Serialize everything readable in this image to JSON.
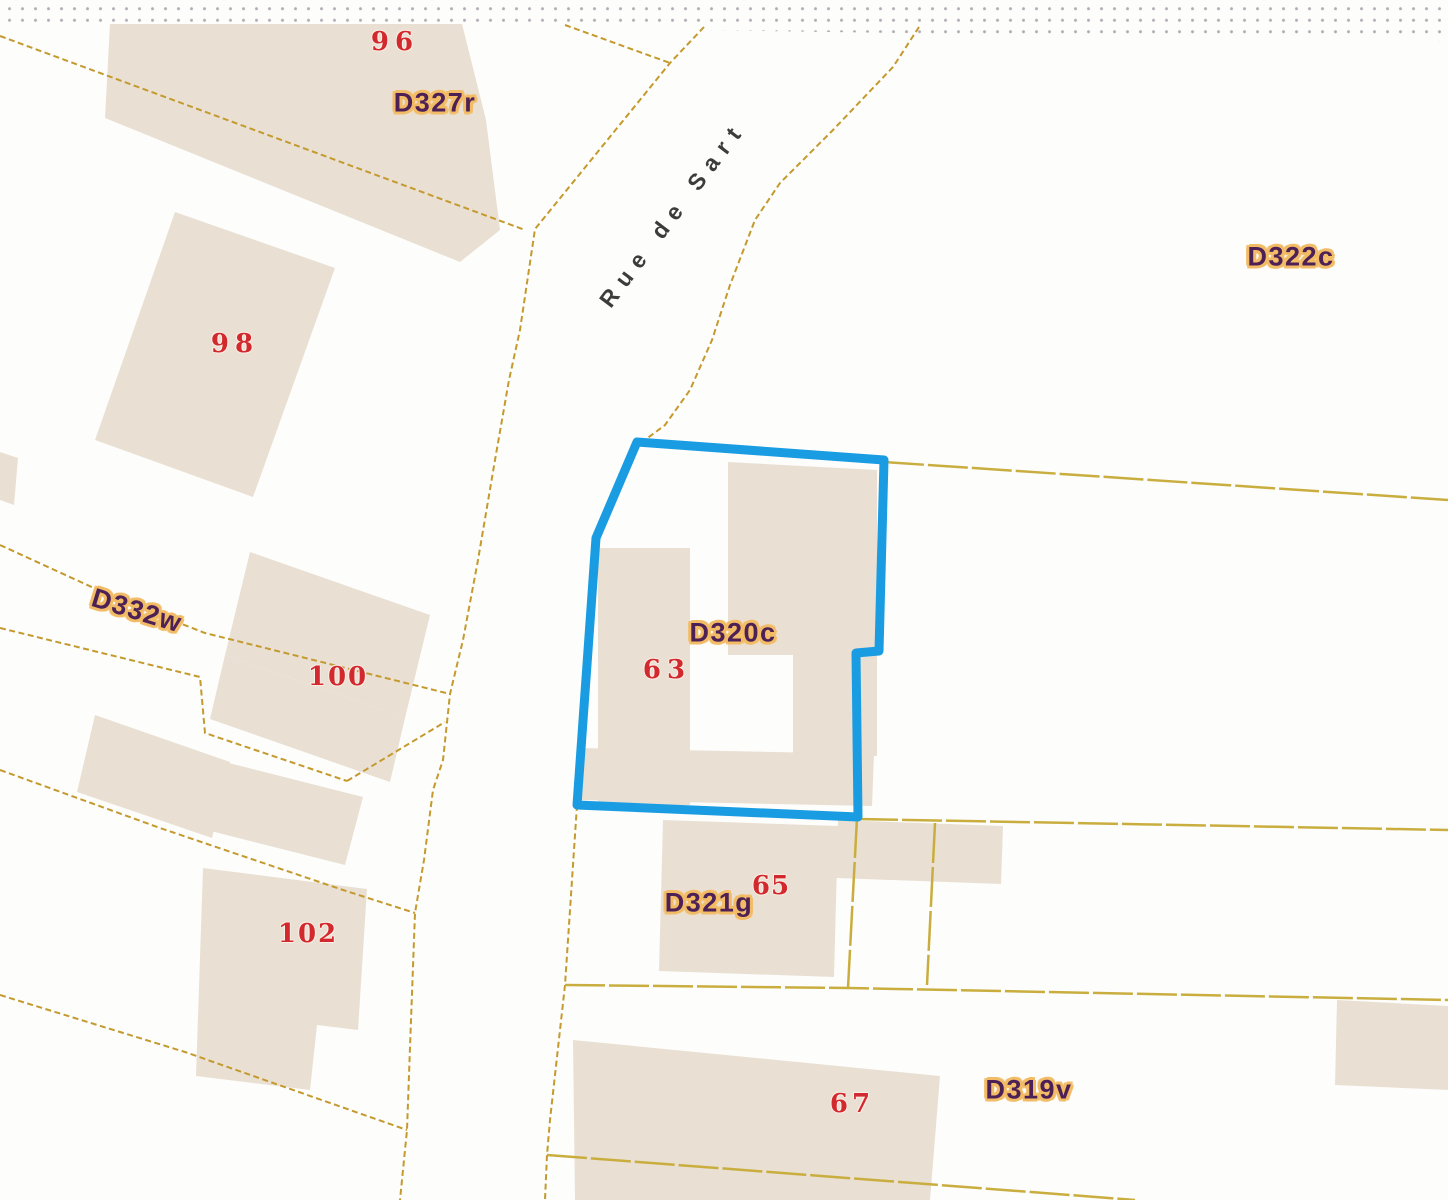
{
  "map": {
    "description": "Cadastral parcel map extract",
    "street": {
      "name": "Rue de Sart"
    },
    "highlighted_parcel": {
      "id": "D320c",
      "house_number": "63"
    },
    "parcels": [
      {
        "id": "D327r",
        "house_numbers": [
          "96"
        ]
      },
      {
        "id": "D332w",
        "house_numbers": [
          "98",
          "100",
          "102"
        ]
      },
      {
        "id": "D322c",
        "house_numbers": []
      },
      {
        "id": "D320c",
        "house_numbers": [
          "63"
        ]
      },
      {
        "id": "D321g",
        "house_numbers": [
          "65"
        ]
      },
      {
        "id": "D319v",
        "house_numbers": [
          "67"
        ]
      }
    ],
    "colors": {
      "background": "#fdfdfb",
      "building_fill": "#e9e0d3",
      "lot_line": "#c49a2e",
      "lot_line_long": "#c9ae3f",
      "highlight_outline": "#1a9ce2",
      "parcel_label_text": "#4d2155",
      "parcel_label_halo": "#f2bb66",
      "house_number_text": "#d2292e",
      "street_text": "#3c3c3c",
      "edge_dots": "#b3abb5"
    },
    "labels": [
      {
        "text": "96",
        "type": "num",
        "x": 395,
        "y": 42,
        "rot": 0,
        "ls": 6
      },
      {
        "text": "D327r",
        "type": "parcel",
        "x": 435,
        "y": 103,
        "rot": 0
      },
      {
        "text": "98",
        "type": "num",
        "x": 235,
        "y": 344,
        "rot": 0,
        "ls": 6
      },
      {
        "text": "D322c",
        "type": "parcel",
        "x": 1291,
        "y": 257,
        "rot": 0
      },
      {
        "text": "Rue de Sart",
        "type": "street",
        "x": 673,
        "y": 214,
        "rot": -53
      },
      {
        "text": "D332w",
        "type": "parcel",
        "x": 137,
        "y": 611,
        "rot": 17
      },
      {
        "text": "100",
        "type": "num",
        "x": 338,
        "y": 677,
        "rot": 0,
        "ls": 2
      },
      {
        "text": "102",
        "type": "num",
        "x": 308,
        "y": 934,
        "rot": 0,
        "ls": 2
      },
      {
        "text": "D320c",
        "type": "parcel",
        "x": 733,
        "y": 633,
        "rot": 0
      },
      {
        "text": "63",
        "type": "num",
        "x": 667,
        "y": 670,
        "rot": 0,
        "ls": 6
      },
      {
        "text": "D321g",
        "type": "parcel",
        "x": 709,
        "y": 903,
        "rot": 0
      },
      {
        "text": "65",
        "type": "num",
        "x": 771,
        "y": 886,
        "rot": 0,
        "ls": 1
      },
      {
        "text": "67",
        "type": "num",
        "x": 852,
        "y": 1104,
        "rot": 0,
        "ls": 4
      },
      {
        "text": "D319v",
        "type": "parcel",
        "x": 1029,
        "y": 1090,
        "rot": 0
      }
    ],
    "buildings": [
      {
        "id": "building-96",
        "points": [
          [
            110,
            24
          ],
          [
            462,
            24
          ],
          [
            486,
            120
          ],
          [
            500,
            230
          ],
          [
            460,
            262
          ],
          [
            105,
            118
          ]
        ]
      },
      {
        "id": "building-98",
        "points": [
          [
            175,
            212
          ],
          [
            335,
            268
          ],
          [
            253,
            497
          ],
          [
            95,
            440
          ]
        ]
      },
      {
        "id": "building-left-stub",
        "points": [
          [
            0,
            452
          ],
          [
            18,
            458
          ],
          [
            14,
            505
          ],
          [
            0,
            500
          ]
        ]
      },
      {
        "id": "building-100-a",
        "points": [
          [
            250,
            552
          ],
          [
            430,
            615
          ],
          [
            405,
            718
          ],
          [
            225,
            655
          ]
        ]
      },
      {
        "id": "building-100-b",
        "points": [
          [
            225,
            655
          ],
          [
            405,
            718
          ],
          [
            390,
            782
          ],
          [
            210,
            719
          ]
        ]
      },
      {
        "id": "building-100-c",
        "points": [
          [
            217,
            760
          ],
          [
            363,
            797
          ],
          [
            345,
            865
          ],
          [
            199,
            828
          ]
        ]
      },
      {
        "id": "building-100-d",
        "points": [
          [
            95,
            715
          ],
          [
            230,
            762
          ],
          [
            212,
            838
          ],
          [
            77,
            792
          ]
        ]
      },
      {
        "id": "building-102",
        "points": [
          [
            203,
            868
          ],
          [
            367,
            889
          ],
          [
            358,
            1030
          ],
          [
            317,
            1025
          ],
          [
            310,
            1090
          ],
          [
            196,
            1076
          ]
        ]
      },
      {
        "id": "building-63-left",
        "points": [
          [
            598,
            548
          ],
          [
            690,
            548
          ],
          [
            690,
            805
          ],
          [
            598,
            805
          ]
        ]
      },
      {
        "id": "building-63-right",
        "points": [
          [
            728,
            462
          ],
          [
            877,
            470
          ],
          [
            877,
            756
          ],
          [
            793,
            756
          ],
          [
            793,
            655
          ],
          [
            728,
            655
          ]
        ]
      },
      {
        "id": "building-63-bottom",
        "points": [
          [
            580,
            748
          ],
          [
            874,
            754
          ],
          [
            872,
            806
          ],
          [
            578,
            800
          ]
        ]
      },
      {
        "id": "building-65",
        "points": [
          [
            663,
            820
          ],
          [
            838,
            826
          ],
          [
            834,
            977
          ],
          [
            659,
            971
          ]
        ]
      },
      {
        "id": "building-65-ext",
        "points": [
          [
            838,
            820
          ],
          [
            1003,
            826
          ],
          [
            1001,
            884
          ],
          [
            836,
            878
          ]
        ]
      },
      {
        "id": "building-67",
        "points": [
          [
            573,
            1040
          ],
          [
            940,
            1076
          ],
          [
            930,
            1200
          ],
          [
            575,
            1200
          ]
        ]
      },
      {
        "id": "building-319-right",
        "points": [
          [
            1337,
            1000
          ],
          [
            1448,
            1006
          ],
          [
            1448,
            1090
          ],
          [
            1335,
            1085
          ]
        ]
      }
    ],
    "boundary_lines": [
      {
        "id": "lot-line-nw-diagonal",
        "style": "short",
        "points": [
          [
            0,
            36
          ],
          [
            525,
            230
          ]
        ]
      },
      {
        "id": "lot-line-top-spur",
        "style": "short",
        "points": [
          [
            565,
            25
          ],
          [
            670,
            63
          ]
        ]
      },
      {
        "id": "street-left-boundary",
        "style": "short",
        "points": [
          [
            704,
            27
          ],
          [
            670,
            63
          ],
          [
            535,
            229
          ],
          [
            520,
            330
          ],
          [
            509,
            380
          ],
          [
            495,
            460
          ],
          [
            478,
            560
          ],
          [
            463,
            640
          ],
          [
            450,
            694
          ],
          [
            443,
            760
          ],
          [
            433,
            790
          ],
          [
            424,
            860
          ],
          [
            415,
            913
          ],
          [
            411,
            1020
          ],
          [
            407,
            1130
          ],
          [
            400,
            1200
          ]
        ]
      },
      {
        "id": "street-right-boundary",
        "style": "short",
        "points": [
          [
            919,
            27
          ],
          [
            893,
            67
          ],
          [
            833,
            130
          ],
          [
            780,
            183
          ],
          [
            755,
            220
          ],
          [
            730,
            285
          ],
          [
            712,
            340
          ],
          [
            690,
            390
          ],
          [
            665,
            425
          ],
          [
            641,
            443
          ]
        ]
      },
      {
        "id": "street-right-boundary-south",
        "style": "short",
        "points": [
          [
            577,
            805
          ],
          [
            565,
            985
          ],
          [
            550,
            1120
          ],
          [
            547,
            1155
          ],
          [
            545,
            1200
          ]
        ]
      },
      {
        "id": "lot-line-d332w-north",
        "style": "short",
        "points": [
          [
            0,
            545
          ],
          [
            120,
            600
          ],
          [
            205,
            633
          ],
          [
            450,
            694
          ]
        ]
      },
      {
        "id": "lot-line-d332w-mid",
        "style": "short",
        "points": [
          [
            0,
            628
          ],
          [
            200,
            677
          ],
          [
            205,
            733
          ],
          [
            347,
            781
          ]
        ]
      },
      {
        "id": "lot-line-d332w-link",
        "style": "short",
        "points": [
          [
            347,
            781
          ],
          [
            445,
            722
          ]
        ]
      },
      {
        "id": "lot-line-102-north",
        "style": "short",
        "points": [
          [
            0,
            770
          ],
          [
            160,
            828
          ],
          [
            343,
            890
          ],
          [
            415,
            913
          ]
        ]
      },
      {
        "id": "lot-line-102-south",
        "style": "short",
        "points": [
          [
            0,
            995
          ],
          [
            185,
            1052
          ],
          [
            407,
            1130
          ]
        ]
      },
      {
        "id": "lot-line-east-upper",
        "style": "long",
        "points": [
          [
            884,
            462
          ],
          [
            1448,
            500
          ]
        ]
      },
      {
        "id": "lot-line-east-mid",
        "style": "long",
        "points": [
          [
            858,
            819
          ],
          [
            1448,
            830
          ]
        ]
      },
      {
        "id": "lot-line-east-lower",
        "style": "long",
        "points": [
          [
            565,
            985
          ],
          [
            848,
            988
          ],
          [
            1448,
            1000
          ]
        ]
      },
      {
        "id": "lot-line-vert-1",
        "style": "long",
        "points": [
          [
            857,
            818
          ],
          [
            848,
            988
          ]
        ]
      },
      {
        "id": "lot-line-vert-2",
        "style": "long",
        "points": [
          [
            935,
            823
          ],
          [
            927,
            985
          ]
        ]
      },
      {
        "id": "lot-line-bottom-diag",
        "style": "long",
        "points": [
          [
            547,
            1155
          ],
          [
            1135,
            1200
          ]
        ]
      }
    ],
    "highlight_outline_points": [
      [
        637,
        442
      ],
      [
        884,
        460
      ],
      [
        879,
        651
      ],
      [
        856,
        653
      ],
      [
        858,
        817
      ],
      [
        577,
        805
      ],
      [
        596,
        538
      ]
    ]
  }
}
